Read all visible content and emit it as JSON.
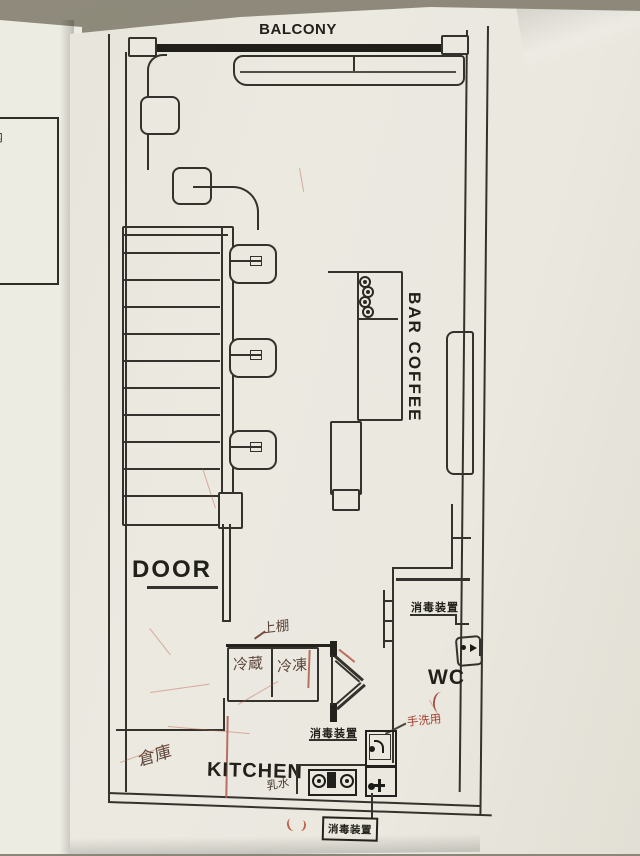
{
  "background_document": {
    "visible_text_lines": [
      "て3箇月以内",
      "った日の翌",
      "と審査請求",
      "豊島区を被",
      "えを提起",
      "内であって",
      "とができな",
      "あったこと",
      "ます。"
    ]
  },
  "floor_plan": {
    "printed_labels": {
      "balcony": "BALCONY",
      "bar_coffee": "BAR COFFEE",
      "door": "DOOR",
      "kitchen": "KITCHEN",
      "wc": "WC",
      "sanitizer": "消毒装置"
    },
    "handwritten_labels": {
      "upper_shelf": "上棚",
      "refrigerator": "冷蔵",
      "freezer": "冷凍",
      "storage": "倉庫",
      "hand_washing": "手洗用",
      "milk_water": "乳水"
    },
    "colors": {
      "paper": "#eae8df",
      "desk": "#8b8678",
      "plan_line": "#34322c",
      "handwriting_dark": "#5c443a",
      "handwriting_red": "#a84b3a",
      "scribble_red": "#c06a57"
    }
  }
}
